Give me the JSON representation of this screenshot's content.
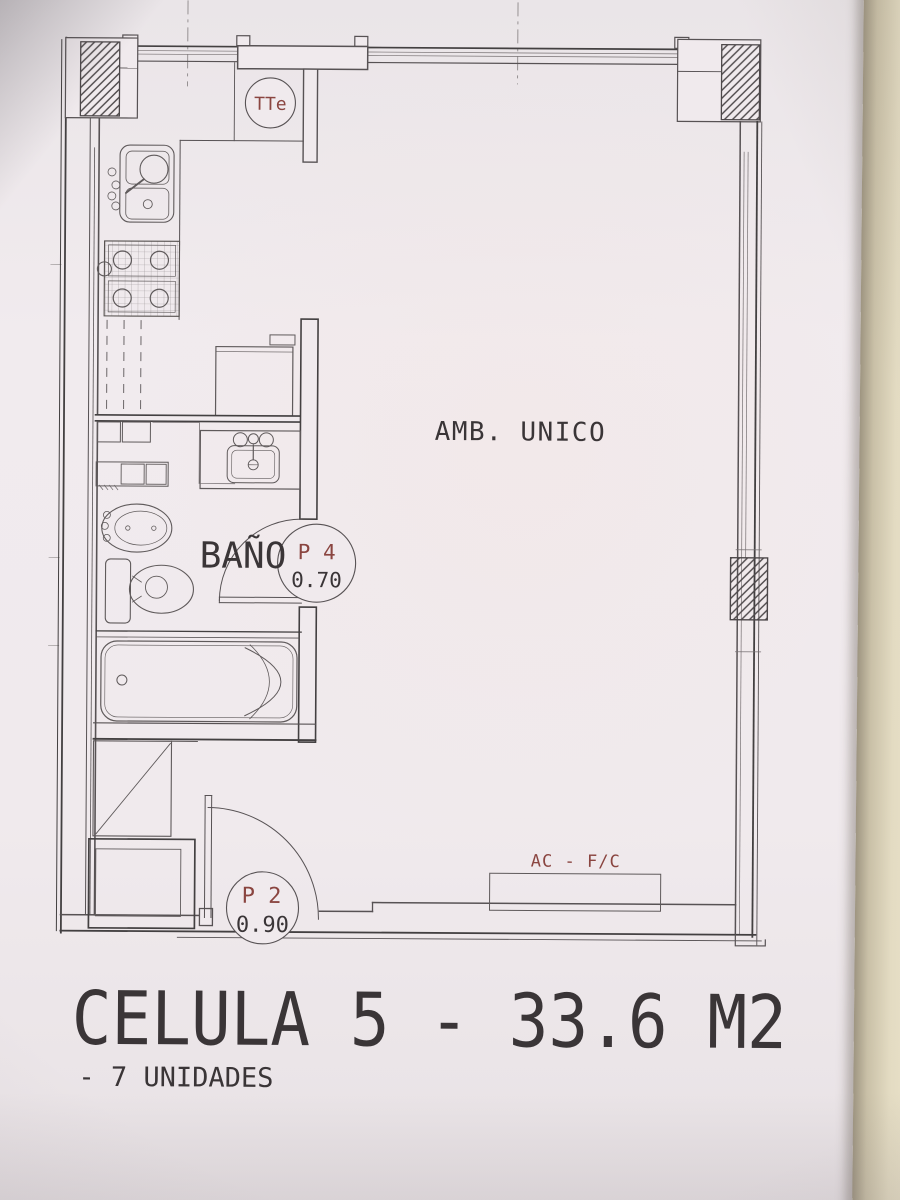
{
  "plan": {
    "title": "CELULA 5 - 33.6 M2",
    "units_note": "- 7 UNIDADES",
    "rooms": {
      "main": "AMB. UNICO",
      "bathroom": "BAÑO"
    },
    "doors": {
      "bathroom": {
        "code": "P 4",
        "width": "0.70"
      },
      "entry": {
        "code": "P 2",
        "width": "0.90"
      }
    },
    "labels": {
      "duct": "TTe",
      "climate": "AC - F/C"
    },
    "colors": {
      "paper": "#f0eaed",
      "ink": "#575254",
      "accent": "#8a4540",
      "text": "#3a3537",
      "desk_edge": "#e3dbc2"
    }
  }
}
